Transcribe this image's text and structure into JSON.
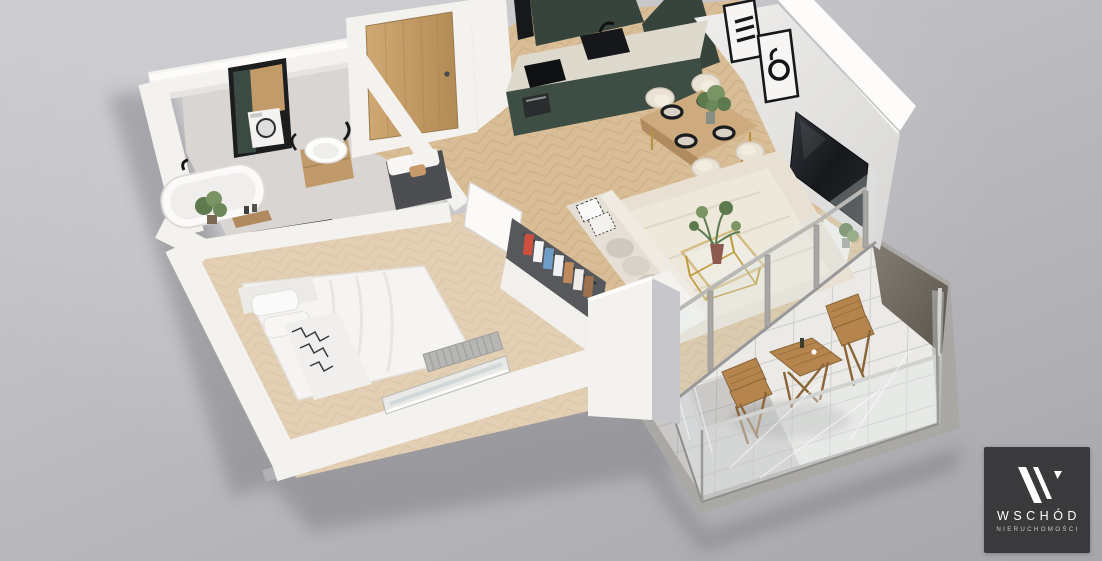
{
  "logo": {
    "monogram": "W",
    "title": "WSCHÓD",
    "subtitle": "NIERUCHOMOŚCI"
  },
  "scene": {
    "type": "3d-apartment-floor-plan-render",
    "areas": [
      "bathroom",
      "entry-hall",
      "kitchen",
      "dining-area",
      "living-room",
      "bedroom",
      "wardrobe",
      "balcony"
    ],
    "furnishings": [
      "bathtub",
      "washbasin-vanity",
      "washing-machine-niche",
      "entry-door",
      "hall-bench",
      "kitchen-cabinets",
      "kitchen-sink",
      "cooktop",
      "oven",
      "dining-table",
      "dining-chairs",
      "wall-art-frames",
      "tv",
      "tv-console",
      "sofa",
      "coffee-table",
      "area-rug",
      "clothes-rack",
      "double-bed",
      "radiator",
      "bedroom-window",
      "glass-balcony-doors",
      "glass-railing",
      "outdoor-bistro-table",
      "outdoor-folding-chairs",
      "potted-plants"
    ]
  },
  "palette": {
    "background_top": "#cdcdd1",
    "background_mid": "#bcbcc0",
    "background_bottom": "#a7a7ab",
    "wall": "#f4f2ef",
    "wall_bright": "#fdfcfa",
    "wall_shade": "#e6e4e1",
    "wall_dark": "#c9c8cc",
    "wall_outer_shadow": "#b2b1b5",
    "floor_wood": "#d9bd96",
    "floor_wood_line": "#bfa076",
    "floor_wood_light": "#e8d7b8",
    "bathroom_floor": "#d8d5d2",
    "kitchen_green": "#3e4e44",
    "kitchen_green_dark": "#36443c",
    "counter": "#ded9cd",
    "appliance_black": "#141619",
    "door_wood": "#c49c68",
    "door_wood_dark": "#a8824f",
    "bench_gray": "#4c4e52",
    "rug": "#e8e1d3",
    "sofa": "#e5dfd5",
    "cushion_gray": "#cfc9c0",
    "pattern_dark": "#2b2b2d",
    "table_wood": "#cdab7e",
    "chair_cream": "#eae3d5",
    "gold": "#c09a3e",
    "plant_green": "#5d7a4e",
    "plant_green_light": "#7b9464",
    "tv_dark": "#1e2226",
    "glass": "#dfe7e8",
    "glass_frame": "#a7a6a3",
    "balcony_slab": "#a9a8a5",
    "balcony_floor": "#eceae6",
    "tile_line": "#c6c5c2",
    "outdoor_wood": "#b5854d",
    "outdoor_wood_dark": "#8a6538",
    "wardrobe_dark": "#56585c",
    "shadow": "#63636b",
    "clothes_1": "#cf4f3f",
    "clothes_2": "#f5f4f2",
    "clothes_3": "#6e9ec7",
    "clothes_4": "#eef0f3",
    "clothes_5": "#c08a5c",
    "clothes_6": "#efece8",
    "clothes_7": "#9c7250",
    "logo_bg": "#3a3a3c",
    "logo_fg": "#ffffff",
    "logo_sub": "#c9c9c9"
  }
}
